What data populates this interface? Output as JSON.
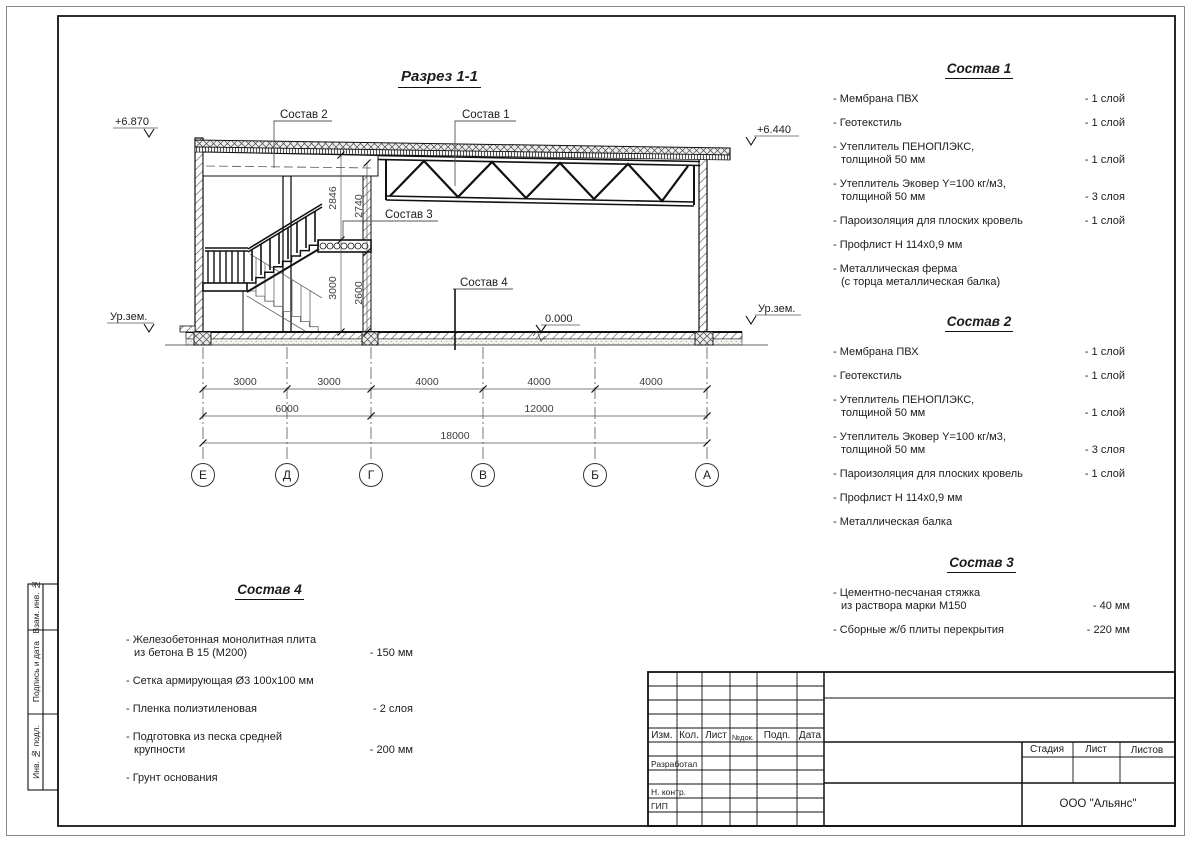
{
  "drawing": {
    "title": "Разрез 1-1",
    "labels": {
      "sostav1": "Состав 1",
      "sostav2": "Состав 2",
      "sostav3": "Состав 3",
      "sostav4": "Состав 4",
      "ground_left": "Ур.зем.",
      "ground_right": "Ур.зем.",
      "elev_left": "+6.870",
      "elev_right": "+6.440",
      "elev_zero": "0.000"
    },
    "dimensions": {
      "row1": [
        "3000",
        "3000",
        "4000",
        "4000",
        "4000"
      ],
      "row2": [
        "6000",
        "12000"
      ],
      "row3": [
        "18000"
      ],
      "vert_upper": [
        "2846",
        "2740"
      ],
      "vert_lower": [
        "3000",
        "2600"
      ],
      "axes": [
        "Е",
        "Д",
        "Г",
        "В",
        "Б",
        "А"
      ]
    }
  },
  "compositions": [
    {
      "title": "Состав 1",
      "items": [
        {
          "name": "- Мембрана ПВХ",
          "qty": "- 1 слой"
        },
        {
          "name": "- Геотекстиль",
          "qty": "- 1 слой"
        },
        {
          "name": "- Утеплитель ПЕНОПЛЭКС,\nтолщиной 50 мм",
          "qty": "- 1 слой"
        },
        {
          "name": "- Утеплитель Эковер Y=100 кг/м3,\nтолщиной 50 мм",
          "qty": "- 3 слоя"
        },
        {
          "name": "- Пароизоляция для плоских кровель",
          "qty": "- 1 слой"
        },
        {
          "name": "- Профлист Н 114х0,9 мм",
          "qty": ""
        },
        {
          "name": "- Металлическая ферма\n(с торца металлическая балка)",
          "qty": ""
        }
      ]
    },
    {
      "title": "Состав 2",
      "items": [
        {
          "name": "- Мембрана ПВХ",
          "qty": "- 1 слой"
        },
        {
          "name": "- Геотекстиль",
          "qty": "- 1 слой"
        },
        {
          "name": "- Утеплитель ПЕНОПЛЭКС,\nтолщиной 50 мм",
          "qty": "- 1 слой"
        },
        {
          "name": "- Утеплитель Эковер Y=100 кг/м3,\nтолщиной 50 мм",
          "qty": "- 3 слоя"
        },
        {
          "name": "- Пароизоляция для плоских кровель",
          "qty": "- 1 слой"
        },
        {
          "name": "- Профлист Н 114х0,9 мм",
          "qty": ""
        },
        {
          "name": "- Металлическая балка",
          "qty": ""
        }
      ]
    },
    {
      "title": "Состав 3",
      "items": [
        {
          "name": "- Цементно-песчаная стяжка\nиз раствора марки М150",
          "qty": "- 40 мм"
        },
        {
          "name": "- Сборные ж/б плиты перекрытия",
          "qty": "- 220 мм"
        }
      ]
    },
    {
      "title": "Состав 4",
      "items": [
        {
          "name": "- Железобетонная монолитная плита\nиз бетона В 15 (М200)",
          "qty": "- 150 мм"
        },
        {
          "name": "- Сетка армирующая Ø3 100х100 мм",
          "qty": ""
        },
        {
          "name": "- Пленка полиэтиленовая",
          "qty": "- 2 слоя"
        },
        {
          "name": "- Подготовка из песка средней\nкрупности",
          "qty": "- 200 мм"
        },
        {
          "name": "- Грунт основания",
          "qty": ""
        }
      ]
    }
  ],
  "stamp": {
    "rev_headers": [
      "Изм.",
      "Кол.",
      "Лист",
      "№док.",
      "Подп.",
      "Дата"
    ],
    "roles": [
      "Разработал",
      "Н. контр.",
      "ГИП"
    ],
    "info_headers": [
      "Стадия",
      "Лист",
      "Листов"
    ],
    "company": "ООО \"Альянс\""
  },
  "side_strip": {
    "labels": [
      "Взам. инв. №",
      "Подпись и дата",
      "Инв. № подл."
    ]
  }
}
